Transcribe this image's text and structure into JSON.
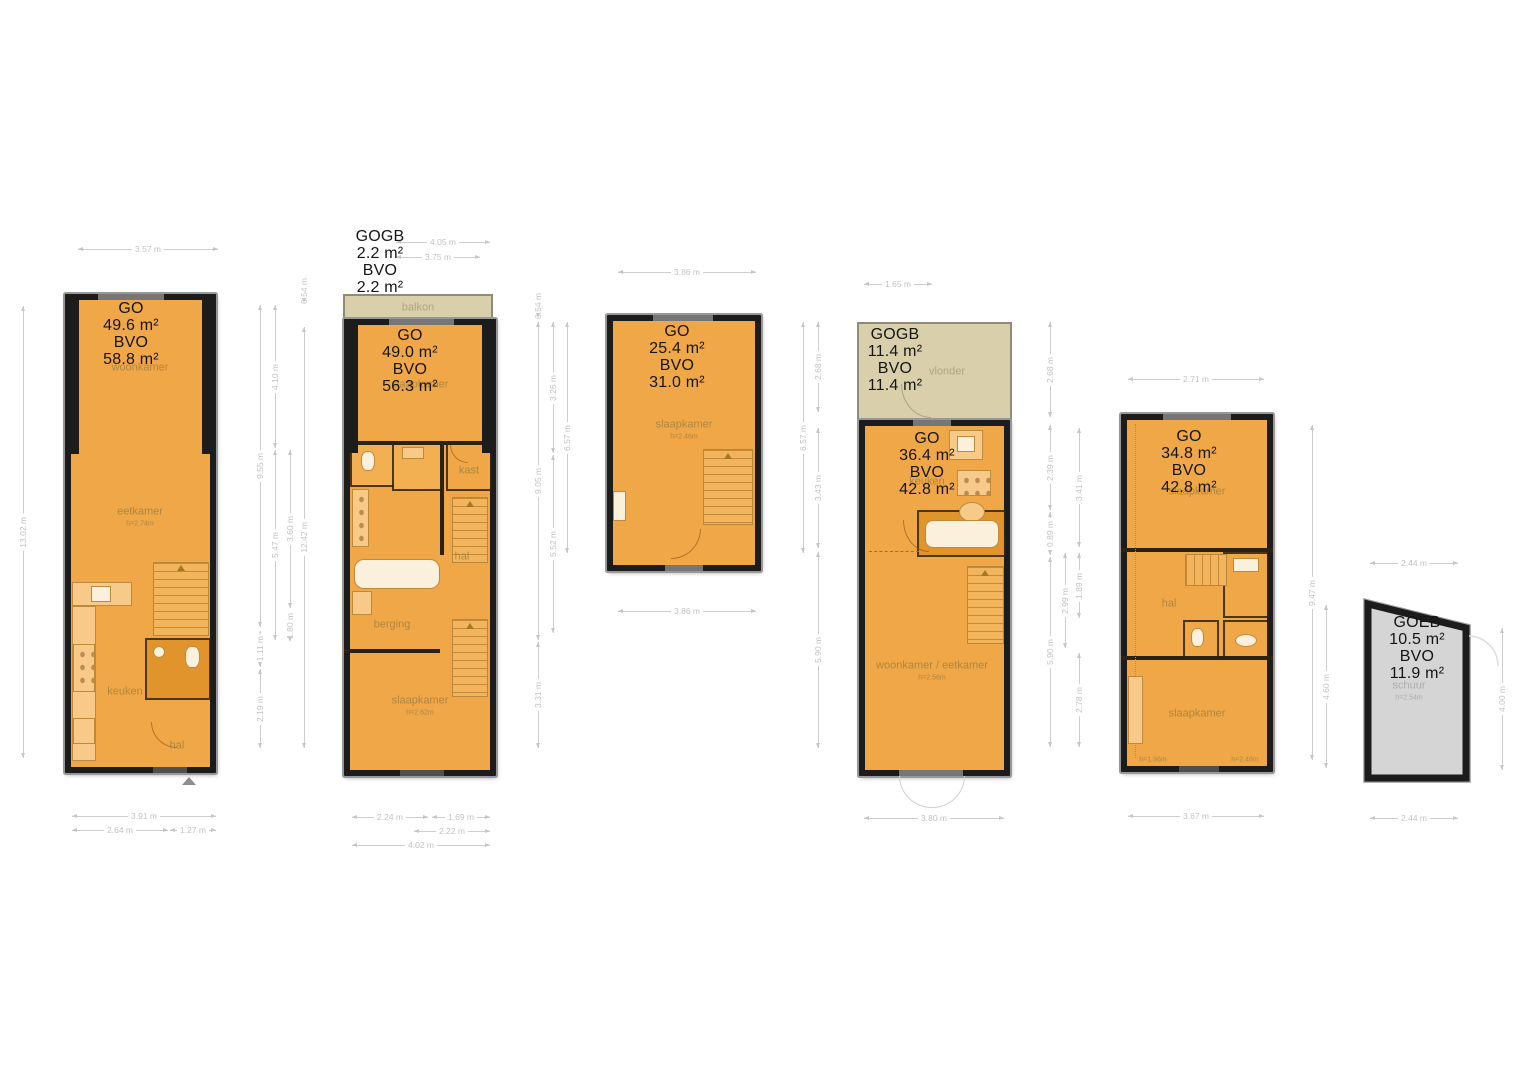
{
  "plans": {
    "p1": {
      "area": [
        "GO",
        "49.6 m²",
        "BVO",
        "58.8 m²"
      ],
      "rooms": {
        "woonkamer": "woonkamer",
        "eetkamer": "eetkamer",
        "eetkamer_h": "h=2.74m",
        "keuken": "keuken",
        "hal": "hal"
      }
    },
    "p2": {
      "gogb": [
        "GOGB",
        "2.2 m²",
        "BVO",
        "2.2 m²"
      ],
      "balkon": "balkon",
      "area": [
        "GO",
        "49.0 m²",
        "BVO",
        "56.3 m²"
      ],
      "rooms": {
        "slaapkamer_top": "slaapkamer",
        "kast": "kast",
        "hal": "hal",
        "berging": "berging",
        "slaapkamer": "slaapkamer",
        "slaapkamer_h": "h=2.62m"
      }
    },
    "p3": {
      "area": [
        "GO",
        "25.4 m²",
        "BVO",
        "31.0 m²"
      ],
      "rooms": {
        "slaapkamer": "slaapkamer",
        "slaapkamer_h": "h=2.46m"
      }
    },
    "p4": {
      "gogb": [
        "GOGB",
        "11.4 m²",
        "BVO",
        "11.4 m²"
      ],
      "vlonder": "vlonder",
      "area": [
        "GO",
        "36.4 m²",
        "BVO",
        "42.8 m²"
      ],
      "rooms": {
        "keuken": "keuken",
        "woonkamer": "woonkamer / eetkamer",
        "woonkamer_h": "h=2.56m"
      }
    },
    "p5": {
      "area": [
        "GO",
        "34.8 m²",
        "BVO",
        "42.8 m²"
      ],
      "rooms": {
        "slaapkamer_top": "slaapkamer",
        "hal": "hal",
        "slaapkamer": "slaapkamer",
        "h_left": "h=1.96m",
        "h_right": "h=2.48m"
      }
    },
    "p6": {
      "area": [
        "GOEB",
        "10.5 m²",
        "BVO",
        "11.9 m²"
      ],
      "rooms": {
        "schuur": "schuur",
        "schuur_h": "h=2.54m"
      }
    }
  },
  "dims": {
    "p1_top": "3.57 m",
    "p1_left": "13.02 m",
    "p1_r1": "9.55 m",
    "p1_r2": "1.11 m",
    "p1_r3": "2.19 m",
    "p1_r4": "4.10 m",
    "p1_r5": "5.47 m",
    "p1_r6": "3.60 m",
    "p1_r7": "1.80 m",
    "p1_r8": "0.54 m",
    "p1_r9": "12.42 m",
    "p1_b1": "3.91 m",
    "p1_b2": "2.64 m",
    "p1_b3": "1.27 m",
    "p2_t1": "4.05 m",
    "p2_t2": "3.75 m",
    "p2_r1": "0.54 m",
    "p2_r2": "9.05 m",
    "p2_r3": "3.31 m",
    "p2_r4": "3.26 m",
    "p2_r5": "5.52 m",
    "p2_r6": "6.57 m",
    "p2_b1": "2.24 m",
    "p2_b2": "1.69 m",
    "p2_b3": "2.22 m",
    "p2_b4": "4.02 m",
    "p3_top": "3.86 m",
    "p3_r1": "6.57 m",
    "p3_r2": "2.68 m",
    "p3_r3": "3.43 m",
    "p3_r4": "5.90 m",
    "p3_bottom": "3.86 m",
    "p4_top": "1.65 m",
    "p4_r1": "2.68 m",
    "p4_r2": "2.39 m",
    "p4_r3": "0.89 m",
    "p4_r4": "5.90 m",
    "p4_r5": "2.99 m",
    "p4_r6": "3.41 m",
    "p4_r7": "1.89 m",
    "p4_r8": "2.78 m",
    "p4_bottom": "3.80 m",
    "p5_top": "2.71 m",
    "p5_r1": "9.47 m",
    "p5_r2": "4.60 m",
    "p5_bottom": "3.67 m",
    "p6_top": "2.44 m",
    "p6_right": "4.00 m",
    "p6_bottom": "2.44 m"
  },
  "colors": {
    "floor": "#F0A747",
    "floor_dark": "#E2942C",
    "wall": "#1C1C1C",
    "balcony": "#D9CFAA",
    "shed": "#D5D5D5",
    "dimension": "#C6C6C6"
  }
}
